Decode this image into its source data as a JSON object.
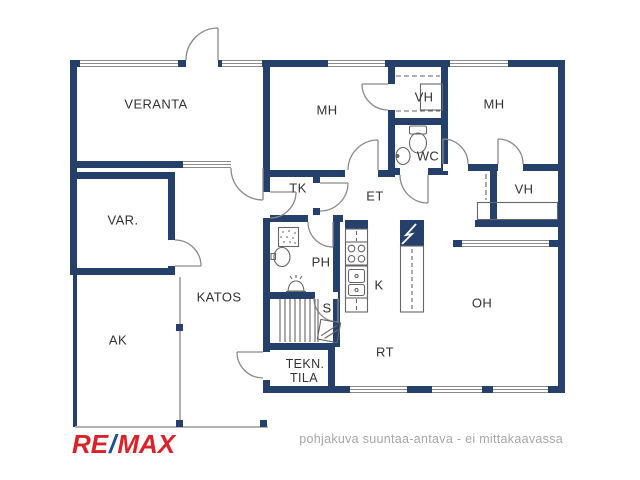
{
  "page": {
    "background": "#ffffff",
    "type": "floor-plan"
  },
  "palette": {
    "wall": "#24406b",
    "line": "#8a8a8a",
    "fixture": "#666666",
    "label": "#333333",
    "footer_text": "#a6a6a6",
    "logo_red": "#d8232a",
    "logo_blue": "#1d4f91"
  },
  "rooms": {
    "veranta": "VERANTA",
    "mh_left": "MH",
    "vh_top": "VH",
    "mh_right": "MH",
    "wc": "WC",
    "tk": "TK",
    "et": "ET",
    "vh_right": "VH",
    "var": "VAR.",
    "ph": "PH",
    "k": "K",
    "katos": "KATOS",
    "s": "S",
    "oh": "OH",
    "ak": "AK",
    "rt": "RT",
    "tekn_line1": "TEKN.",
    "tekn_line2": "TILA"
  },
  "branding": {
    "re": "RE",
    "slash": "/",
    "max": "MAX"
  },
  "footer": {
    "disclaimer": "pohjakuva suuntaa-antava - ei mittakaavassa"
  },
  "icons": [
    "door-swing-icon",
    "toilet-icon",
    "wc-sink-icon",
    "ph-sink-icon",
    "shower-icon",
    "sauna-stove-icon",
    "sauna-benches-icon",
    "sauna-glass-door-icon",
    "stove-icon",
    "kitchen-sink-icon",
    "fireplace-icon",
    "wardrobe-icon",
    "closet-shelf-icon",
    "window-icon",
    "post-icon"
  ]
}
